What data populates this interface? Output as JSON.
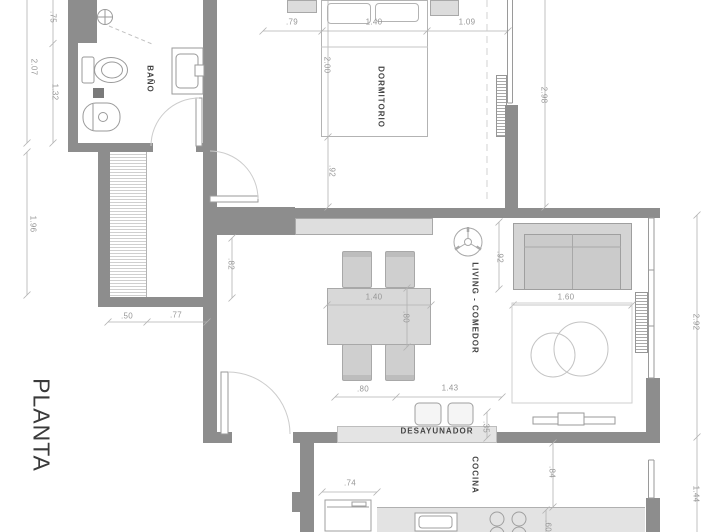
{
  "title": {
    "plan_label": "PLANTA"
  },
  "rooms": {
    "bathroom": "BAÑO",
    "bedroom": "DORMITORIO",
    "living_dining": "LIVING - COMEDOR",
    "breakfast_bar": "DESAYUNADOR",
    "kitchen": "COCINA"
  },
  "dims": {
    "bath_top_h": ".75",
    "bath_total_h": "2.07",
    "bath_inner_h": "1.32",
    "shaft_h": "1.96",
    "bed_left_w": ".79",
    "bed_w": "1.40",
    "bed_right_w": "1.09",
    "bed_len": "2.00",
    "bed_foot_gap": ".92",
    "bedroom_right_h": "2.98",
    "shaft_w": ".50",
    "hall_w": ".77",
    "living_left_jog": ".82",
    "table_w": "1.40",
    "table_d": ".80",
    "sofa_gap": ".92",
    "sofa_front_w": "1.60",
    "living_right_h": "2.92",
    "pass_left_w": ".80",
    "breakfast_w": "1.43",
    "counter_d": ".35",
    "fridge_w": ".74",
    "kitchen_gap_h": ".84",
    "counter_depth": ".60",
    "kitchen_right_h": "1.44"
  },
  "colors": {
    "wall": "#8d8d8d",
    "furniture": "#d6d6d6",
    "counter": "#e4e4e4",
    "dim_text": "#979797",
    "label_text": "#454545",
    "line": "#b2b2b2"
  }
}
